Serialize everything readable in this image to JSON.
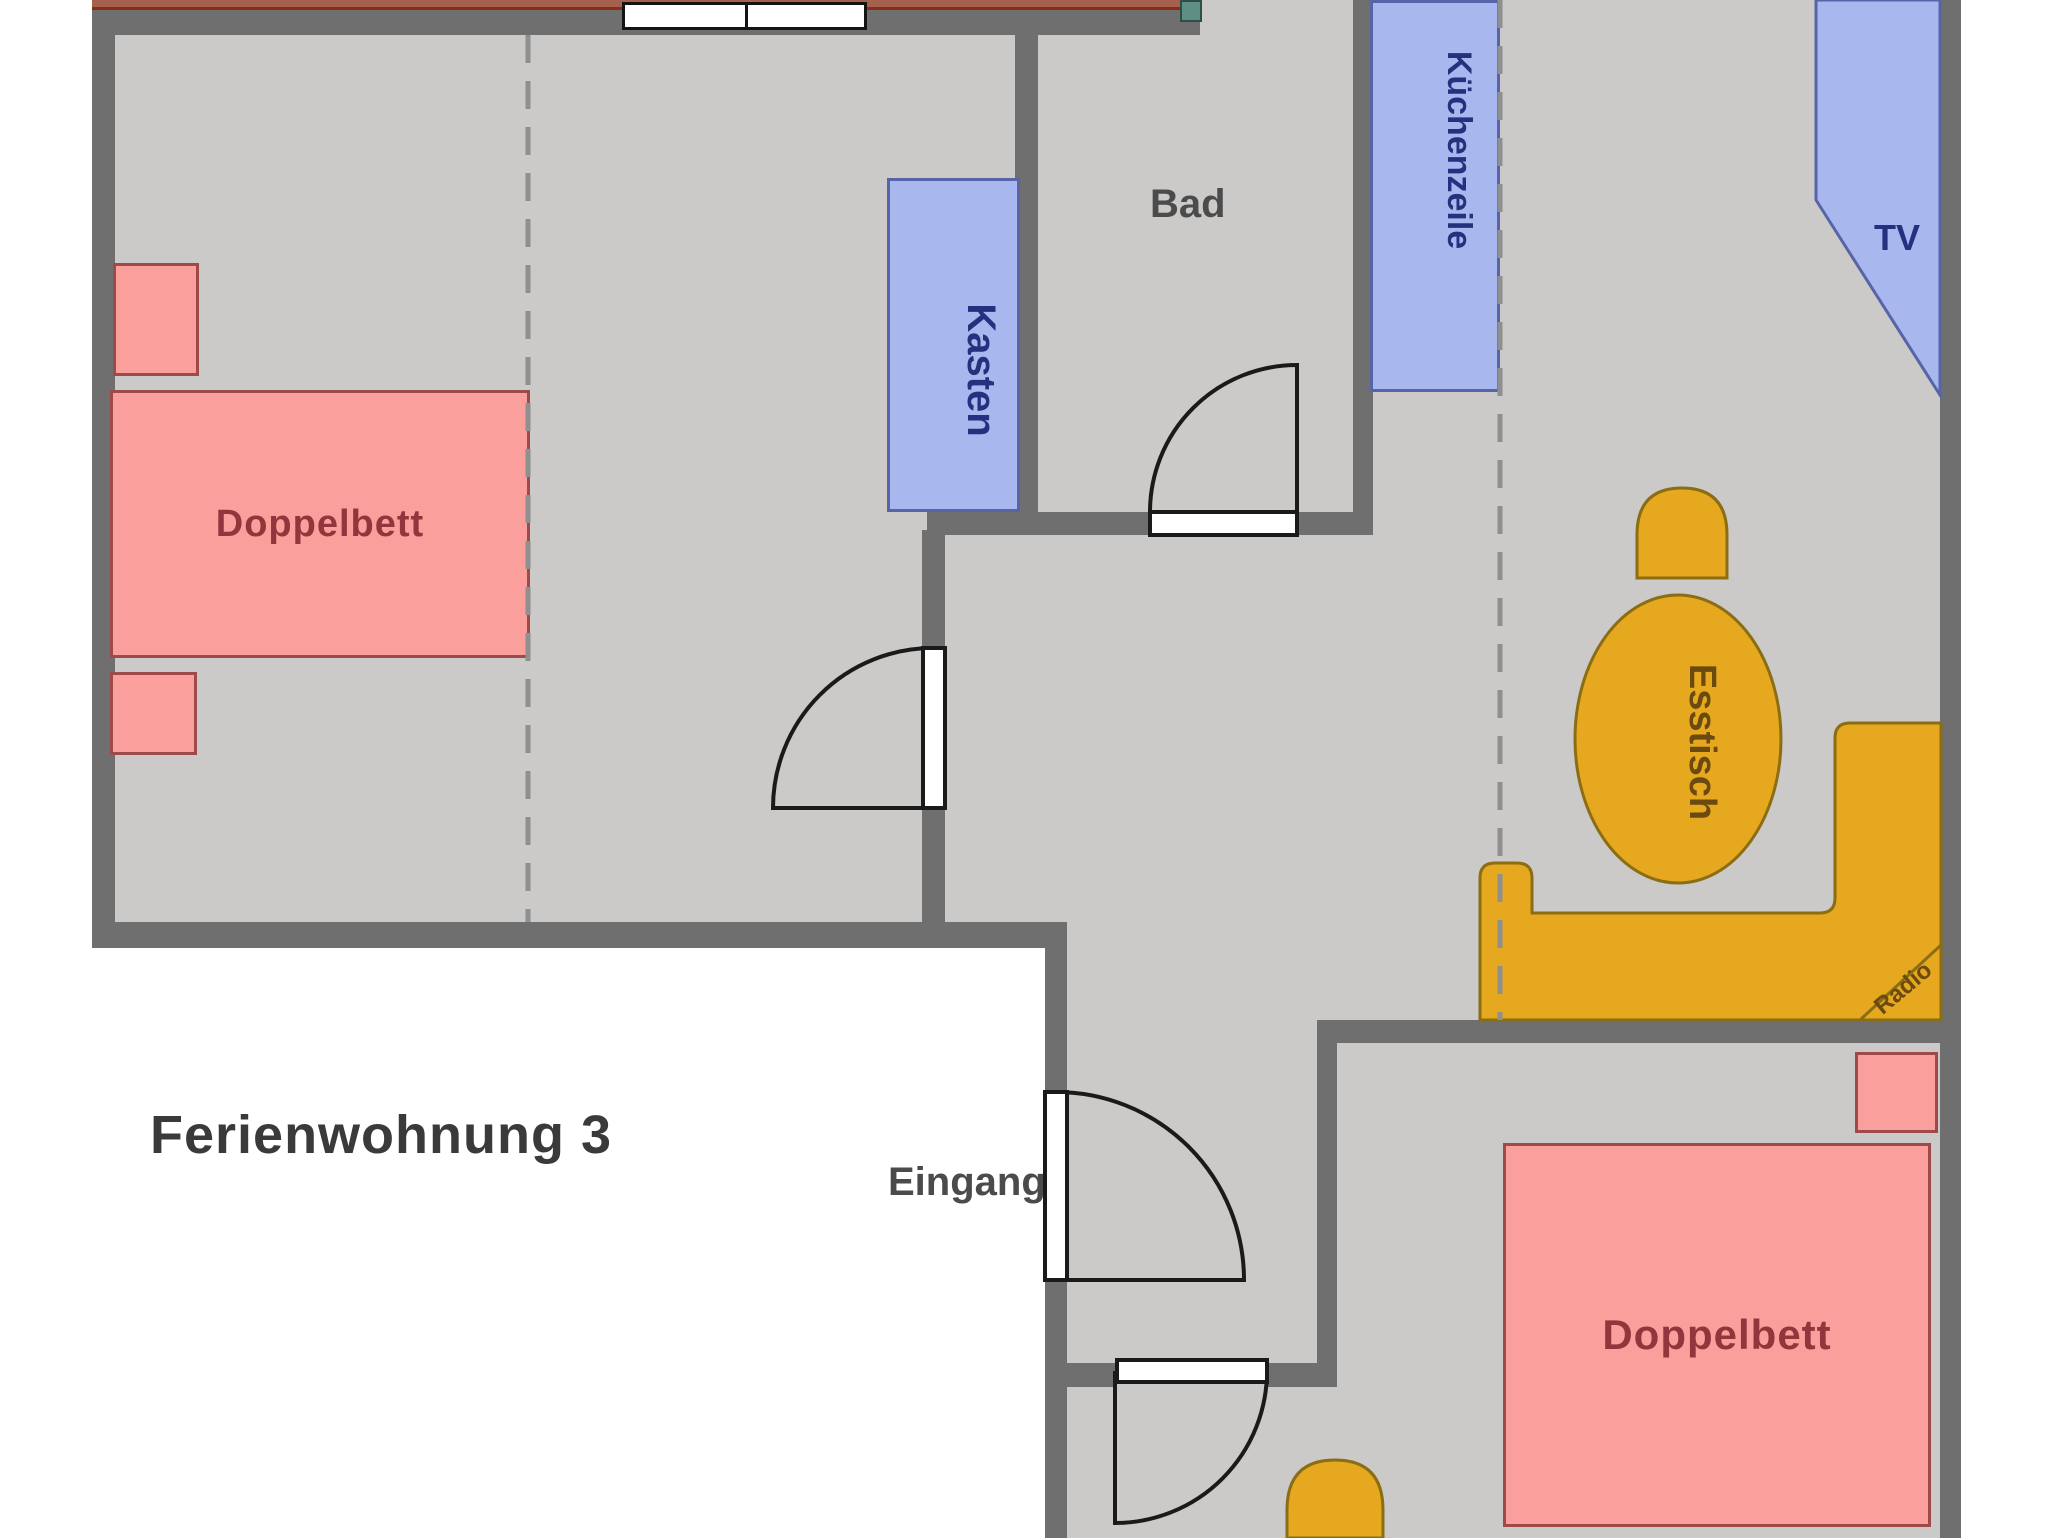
{
  "title": "Ferienwohnung 3",
  "rooms": {
    "bathroom": "Bad",
    "entrance": "Eingang"
  },
  "furniture": {
    "double_bed_left": "Doppelbett",
    "double_bed_right": "Doppelbett",
    "wardrobe": "Kasten",
    "kitchenette": "Küchenzeile",
    "tv": "TV",
    "dining_table": "Esstisch",
    "radio": "Radio"
  },
  "colors": {
    "floor": "#cbcac8",
    "wall": "#6f6f6f",
    "bed_fill": "#fb9f9c",
    "bed_border": "#9c4a4a",
    "blue_fill": "#a8b8ee",
    "blue_border": "#5765a8",
    "wood_fill": "#e6a81e",
    "wood_border": "#8b6d14",
    "sideboard": "#a6604e",
    "plant": "#5d8f84",
    "label_dark_red": "#93353c",
    "label_navy": "#24317e",
    "label_brown": "#6b4a10",
    "room_text": "#4b4b4b",
    "title_text": "#3a3a3a"
  }
}
